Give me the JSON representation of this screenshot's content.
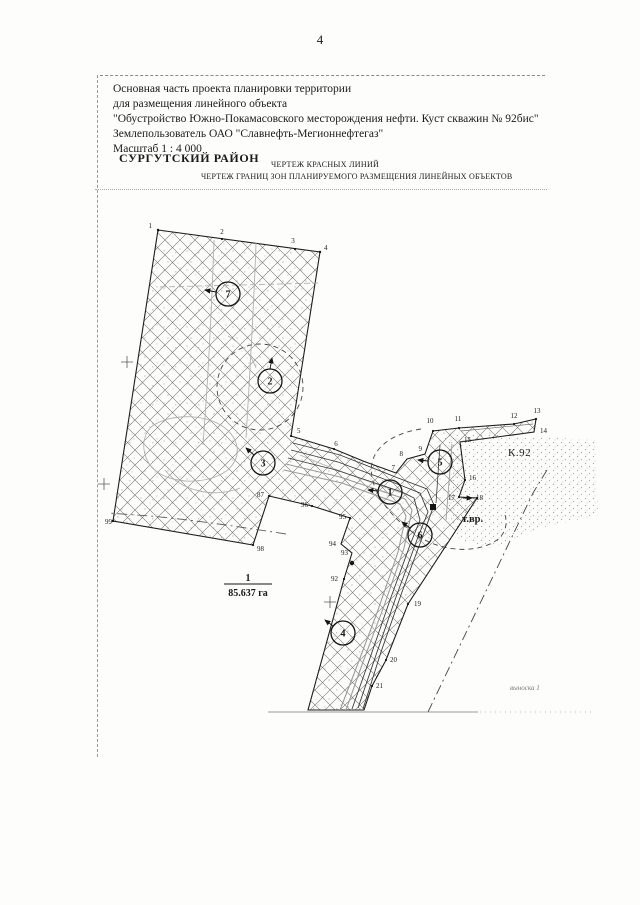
{
  "page": {
    "number": "4"
  },
  "colors": {
    "ink": "#1a1a1a",
    "hatch": "#6f6f6f",
    "paper": "#fdfdfc",
    "faint": "#b3b3b3"
  },
  "header": {
    "lines": [
      "Основная часть проекта планировки территории",
      "для размещения линейного объекта",
      "\"Обустройство Южно-Покамасовского месторождения нефти. Куст скважин № 92бис\"",
      "Землепользователь  ОАО \"Славнефть-Мегионнефтегаз\"",
      "Масштаб 1 : 4 000"
    ],
    "district": "СУРГУТСКИЙ РАЙОН",
    "subtitle1": "ЧЕРТЕЖ КРАСНЫХ ЛИНИЙ",
    "subtitle2": "ЧЕРТЕЖ ГРАНИЦ ЗОН ПЛАНИРУЕМОГО РАЗМЕЩЕНИЯ ЛИНЕЙНЫХ ОБЪЕКТОВ"
  },
  "map": {
    "area": {
      "numerator": "1",
      "denominator": "85.637 га"
    },
    "labels": {
      "well_pad": "К.92",
      "tie_in": "т.вр.",
      "callout": "выноска 1"
    },
    "zone_callouts": [
      {
        "t": "1"
      },
      {
        "t": "2"
      },
      {
        "t": "3"
      },
      {
        "t": "4"
      },
      {
        "t": "5"
      },
      {
        "t": "6"
      },
      {
        "t": "7"
      }
    ],
    "vertices": [
      {
        "t": "1"
      },
      {
        "t": "2"
      },
      {
        "t": "3"
      },
      {
        "t": "4"
      },
      {
        "t": "5"
      },
      {
        "t": "6"
      },
      {
        "t": "7"
      },
      {
        "t": "8"
      },
      {
        "t": "9"
      },
      {
        "t": "10"
      },
      {
        "t": "11"
      },
      {
        "t": "12"
      },
      {
        "t": "13"
      },
      {
        "t": "14"
      },
      {
        "t": "15"
      },
      {
        "t": "16"
      },
      {
        "t": "17"
      },
      {
        "t": "18"
      },
      {
        "t": "19"
      },
      {
        "t": "20"
      },
      {
        "t": "21"
      },
      {
        "t": "87"
      },
      {
        "t": "92"
      },
      {
        "t": "93"
      },
      {
        "t": "94"
      },
      {
        "t": "95"
      },
      {
        "t": "96"
      },
      {
        "t": "98"
      },
      {
        "t": "99"
      }
    ]
  }
}
